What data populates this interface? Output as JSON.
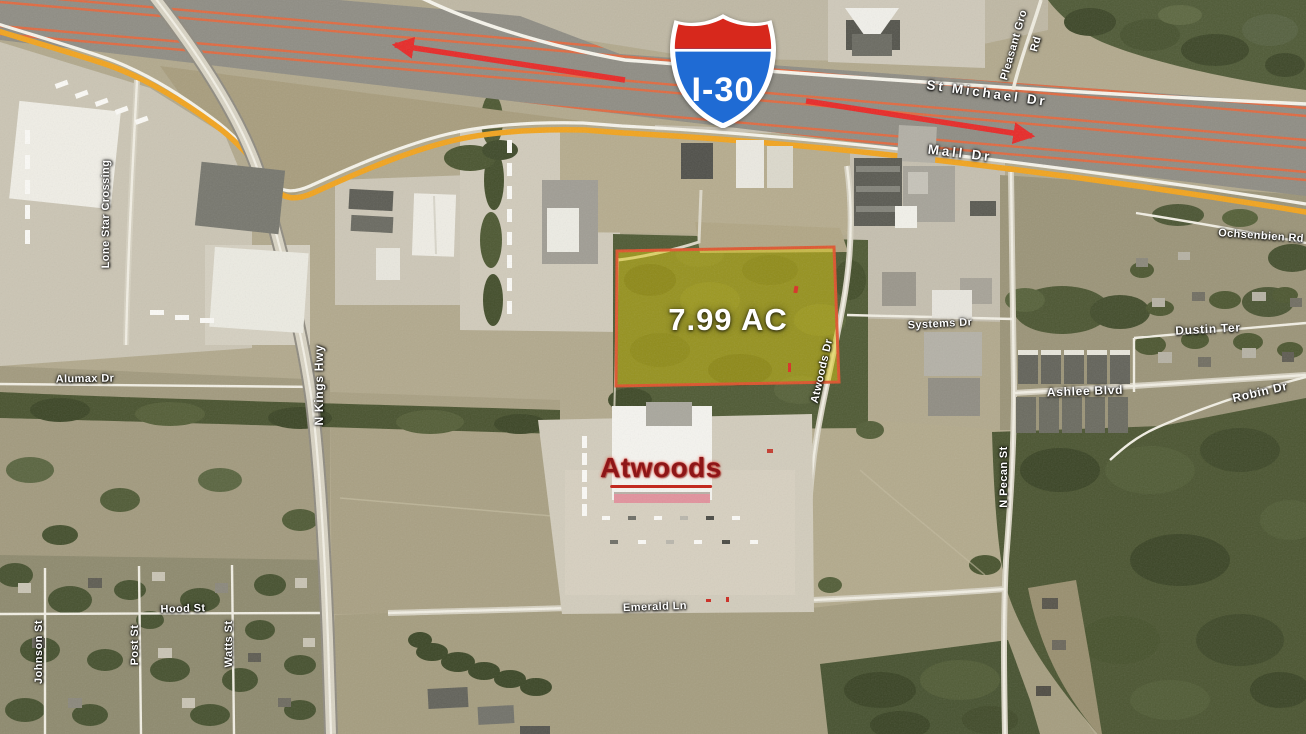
{
  "map": {
    "description": "Aerial satellite site map of highlighted land parcel at I-30 and Mall Dr",
    "parcel": {
      "area_label": "7.99 AC",
      "fill_color": "#ddc90a",
      "border_color": "#e0522c"
    },
    "interstate_shield": {
      "label": "I-30",
      "body_color": "#1f6bd4",
      "crown_color": "#d7281c",
      "outline_color": "#ffffff"
    },
    "store_label": {
      "text": "Atwoods",
      "color": "#8c1618"
    },
    "route_highlight": {
      "road": "Mall Dr",
      "color": "#f2a41e"
    },
    "traffic_arrows": {
      "color": "#ee2322",
      "directions": [
        "westbound",
        "eastbound"
      ]
    },
    "road_labels": [
      {
        "id": "st-michael-dr",
        "text": "St Michael Dr"
      },
      {
        "id": "pleasant-grove-rd-1",
        "text": "Pleasant Gro"
      },
      {
        "id": "pleasant-grove-rd-2",
        "text": "Rd"
      },
      {
        "id": "mall-dr",
        "text": "Mall Dr"
      },
      {
        "id": "ochsenbien-rd",
        "text": "Ochsenbien Rd"
      },
      {
        "id": "lone-star-crossing",
        "text": "Lone Star Crossing"
      },
      {
        "id": "alumax-dr",
        "text": "Alumax Dr"
      },
      {
        "id": "n-kings-hwy",
        "text": "N Kings Hwy"
      },
      {
        "id": "atwoods-dr",
        "text": "Atwoods Dr"
      },
      {
        "id": "systems-dr",
        "text": "Systems Dr"
      },
      {
        "id": "dustin-ter",
        "text": "Dustin Ter"
      },
      {
        "id": "ashlee-blvd",
        "text": "Ashlee Blvd"
      },
      {
        "id": "robin-dr",
        "text": "Robin Dr"
      },
      {
        "id": "n-pecan-st",
        "text": "N Pecan St"
      },
      {
        "id": "hood-st",
        "text": "Hood St"
      },
      {
        "id": "emerald-ln",
        "text": "Emerald Ln"
      },
      {
        "id": "johnson-st",
        "text": "Johnson St"
      },
      {
        "id": "post-st",
        "text": "Post St"
      },
      {
        "id": "watts-st",
        "text": "Watts St"
      }
    ]
  }
}
